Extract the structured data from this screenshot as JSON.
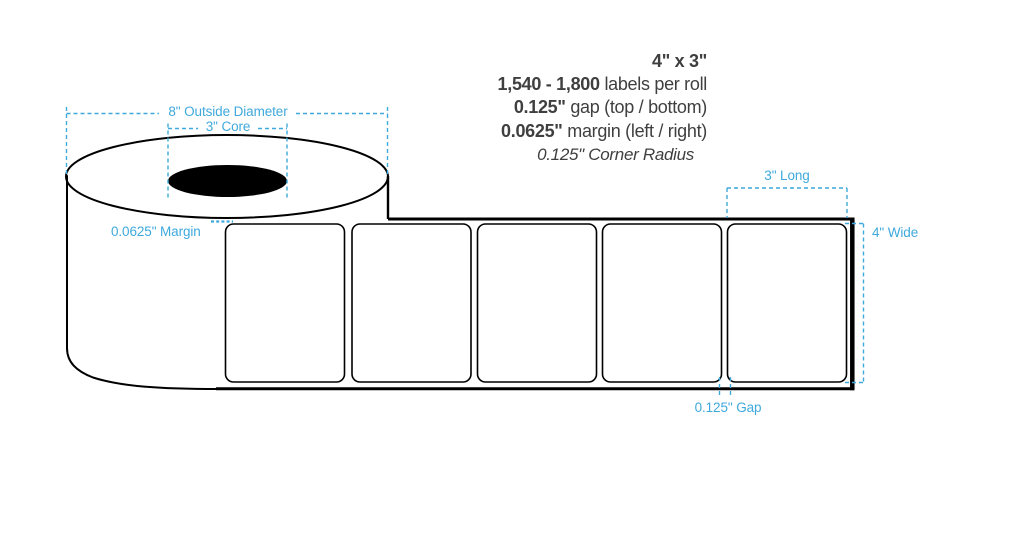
{
  "specs": {
    "size": "4\" x 3\"",
    "quantity_range": "1,540 - 1,800",
    "quantity_suffix": "labels per roll",
    "gap_value": "0.125\"",
    "gap_suffix": "gap (top / bottom)",
    "margin_value": "0.0625\"",
    "margin_suffix": "margin (left / right)",
    "corner_radius": "0.125\" Corner Radius"
  },
  "annotations": {
    "outside_diameter": "8\" Outside Diameter",
    "core": "3\" Core",
    "side_margin": "0.0625\" Margin",
    "label_length": "3\" Long",
    "label_width": "4\" Wide",
    "label_gap": "0.125\" Gap"
  },
  "colors": {
    "accent": "#3FA9DC",
    "ink": "#3F3F3F",
    "outline": "#000000"
  }
}
